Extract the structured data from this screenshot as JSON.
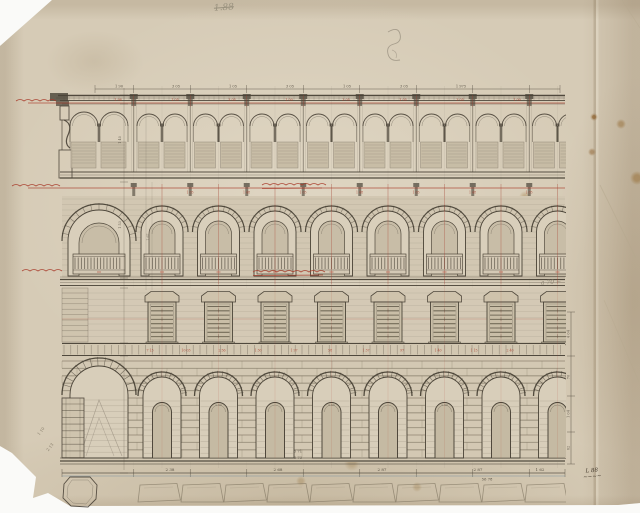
{
  "document": {
    "kind": "scanned architectural elevation drawing (palazzo facade study)",
    "media": "ink and pencil on aged paper with red ink annotations"
  },
  "colors": {
    "paper": "#d6cbb6",
    "ink": "#4a4337",
    "ink_faint": "#8b8172",
    "red": "#a93b2a",
    "pencil": "#8d8475",
    "wall_fill": "#d2c7b2",
    "opening_fill": "#d9cfbb",
    "window_fill": "#c8bda6",
    "scan_background": "#fafaf8"
  },
  "annotations": {
    "pencil_number": "1.88",
    "note_right": "a 70 ~",
    "signature": {
      "line1": "L 88",
      "line2": "~~~~"
    },
    "red_scripts": [
      {
        "id": "left-cornice-note",
        "x": 16,
        "y": 100,
        "approx": "~~~ (illegible red script)"
      },
      {
        "id": "left-impost-note",
        "x": 12,
        "y": 185,
        "approx": "~~~~ (illegible red script)"
      },
      {
        "id": "left-floor-note",
        "x": 22,
        "y": 270,
        "approx": "~~~ (illegible red script)"
      },
      {
        "id": "mid-arch-title",
        "x": 262,
        "y": 184,
        "approx": "~~~~~ (illegible red script, underlined)"
      },
      {
        "id": "mid-balustrade-title",
        "x": 253,
        "y": 271,
        "approx": "~~~~~~ (illegible red script, underlined)"
      }
    ]
  },
  "dimensions": {
    "top_chain": [
      "1 90",
      "3 05",
      "1 05",
      "3 05",
      "1 05",
      "3 05",
      "1 975"
    ],
    "red_cornice_row": [
      "1 98",
      "1 05",
      "3 05",
      "1 00",
      "3 05",
      "1 05",
      "3 05",
      "1 00"
    ],
    "red_arch_row": [
      "1 05",
      "1 48",
      "1 05",
      "1 48",
      "1 05",
      "1 48",
      "1 05"
    ],
    "red_course_row": [
      "7 13",
      "10 03",
      "2 56",
      "1 30",
      "1 97",
      "58",
      "1 37",
      "97",
      "1 40",
      "1 15",
      "2 40"
    ],
    "bay_door_dims": [
      "1 30",
      "2 05",
      "1 30"
    ],
    "bottom_chain": [
      {
        "x": 170,
        "v": "2 38"
      },
      {
        "x": 278,
        "v": "2 68"
      },
      {
        "x": 382,
        "v": "2 87"
      },
      {
        "x": 478,
        "v": "2 87"
      },
      {
        "x": 540,
        "v": "1 62"
      }
    ],
    "bottom_pair": [
      "5 71",
      "5 73"
    ],
    "bottom_total": "56 78",
    "right_chain": [
      "4 04",
      "70",
      "1 04",
      "62"
    ],
    "left_chain": [
      "1 40",
      "1 53",
      "1 67"
    ],
    "left_diagonal": [
      "1 10",
      "2 13"
    ]
  },
  "facade": {
    "left": 62,
    "right": 565,
    "module": 56.5,
    "first_arch_center": 162,
    "arch_count": 8,
    "corner_center": 99,
    "cornice_y": 95,
    "attic": {
      "top": 106,
      "base": 172,
      "arch_r": 12
    },
    "regB": {
      "top": 182,
      "red_line": 188,
      "spring": 232,
      "arch_r": 26,
      "balustrade_top": 254,
      "cornice": 278
    },
    "regC": {
      "top": 288,
      "bottom": 342,
      "red_line": 319
    },
    "course": {
      "top": 343,
      "bottom": 356
    },
    "regD": {
      "top": 356,
      "spring": 396,
      "arch_r": 24,
      "floor": 458
    },
    "plinth": {
      "chain_y": 473
    },
    "foundation": {
      "top": 483,
      "bottom": 504
    }
  }
}
